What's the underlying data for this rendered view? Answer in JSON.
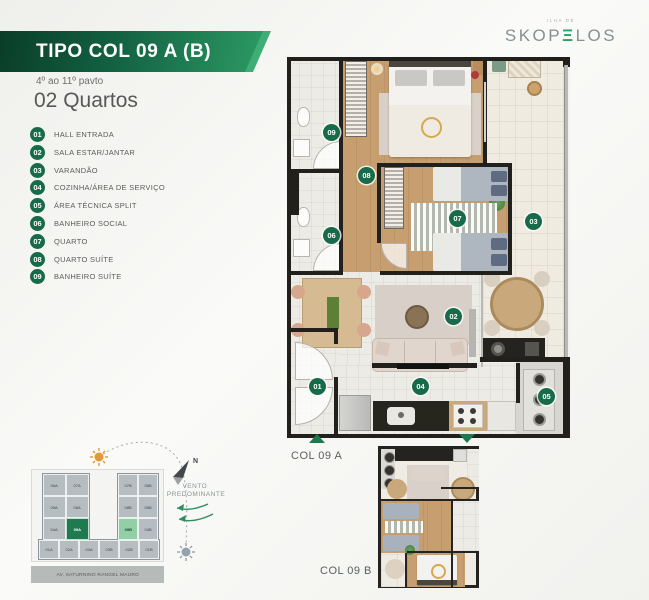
{
  "header": {
    "type_label": "TIPO COL 09 A (B)",
    "floors_label": "4º ao 11º pavto",
    "bedrooms_label": "02 Quartos"
  },
  "brand": {
    "tagline": "ILHA DE",
    "name_start": "SKOP",
    "name_e": "Ξ",
    "name_end": "LOS"
  },
  "legend": {
    "items": [
      {
        "num": "01",
        "label": "HALL ENTRADA"
      },
      {
        "num": "02",
        "label": "SALA ESTAR/JANTAR"
      },
      {
        "num": "03",
        "label": "VARANDÃO"
      },
      {
        "num": "04",
        "label": "COZINHA/ÁREA DE SERVIÇO"
      },
      {
        "num": "05",
        "label": "ÁREA TÉCNICA SPLIT"
      },
      {
        "num": "06",
        "label": "BANHEIRO SOCIAL"
      },
      {
        "num": "07",
        "label": "QUARTO"
      },
      {
        "num": "08",
        "label": "QUARTO SUÍTE"
      },
      {
        "num": "09",
        "label": "BANHEIRO SUÍTE"
      }
    ]
  },
  "plan": {
    "badges": [
      "01",
      "02",
      "03",
      "04",
      "05",
      "06",
      "07",
      "08",
      "09"
    ]
  },
  "markers": {
    "col_a": "COL 09 A",
    "col_b": "COL 09 B"
  },
  "siteplan": {
    "north_label": "N",
    "wind_label_1": "VENTO",
    "wind_label_2": "PREDOMINANTE",
    "street_label": "AV. SATURNINO RANGEL MAURO",
    "tower_a_units": [
      "06A",
      "07A",
      "05A",
      "08A",
      "04A",
      "09A"
    ],
    "tower_b_units": [
      "07B",
      "06B",
      "08B",
      "05B",
      "09B",
      "04B"
    ],
    "ground_units": [
      "01A",
      "02A",
      "03A",
      "03B",
      "02B",
      "01B"
    ],
    "highlighted_a": "09A",
    "highlighted_b": "09B"
  },
  "colors": {
    "banner_dark": "#0b4a30",
    "banner_light": "#2f9e66",
    "badge_green": "#176a4a",
    "highlight_a": "#1e7a4f",
    "highlight_b": "#92cfa7"
  }
}
